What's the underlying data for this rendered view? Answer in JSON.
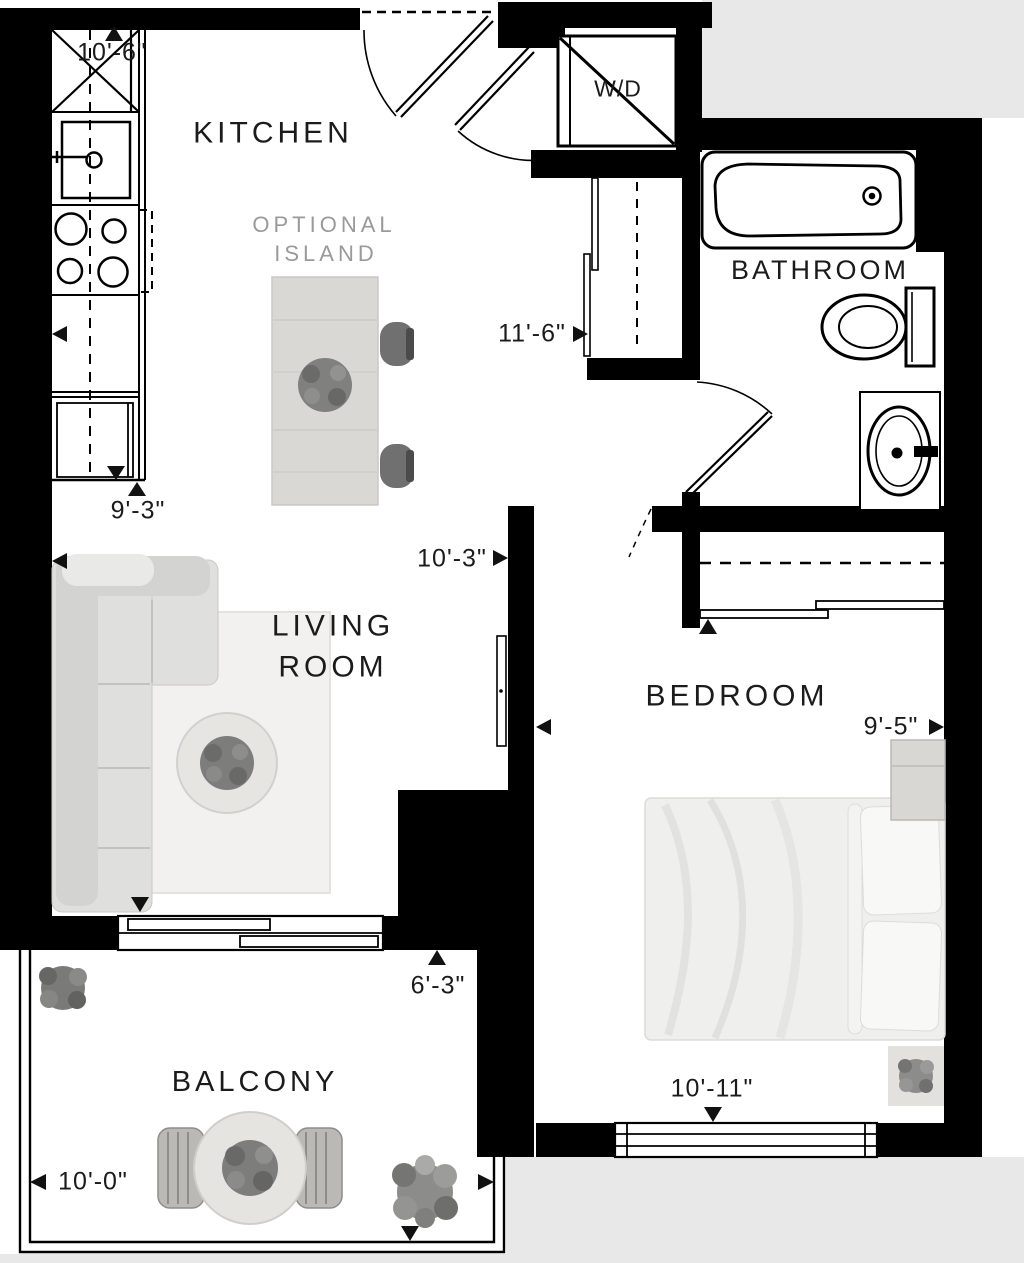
{
  "rooms": {
    "kitchen": "KITCHEN",
    "bathroom": "BATHROOM",
    "living_line1": "LIVING",
    "living_line2": "ROOM",
    "bedroom": "BEDROOM",
    "balcony": "BALCONY"
  },
  "labels": {
    "washer_dryer": "W/D",
    "island_line1": "OPTIONAL",
    "island_line2": "ISLAND"
  },
  "dimensions": {
    "kitchen_height": "10'-6\"",
    "kitchen_width": "11'-6\"",
    "living_height": "9'-3\"",
    "living_width": "10'-3\"",
    "bedroom_width": "9'-5\"",
    "bedroom_height": "10'-11\"",
    "balcony_depth": "6'-3\"",
    "balcony_width": "10'-0\""
  },
  "colors": {
    "wall": "#000000",
    "floor": "#ffffff",
    "exterior": "#e8e8e8",
    "muted_label": "#9a9a9a",
    "text": "#1b1b1b",
    "furniture_gray": "#dfdfdd"
  }
}
